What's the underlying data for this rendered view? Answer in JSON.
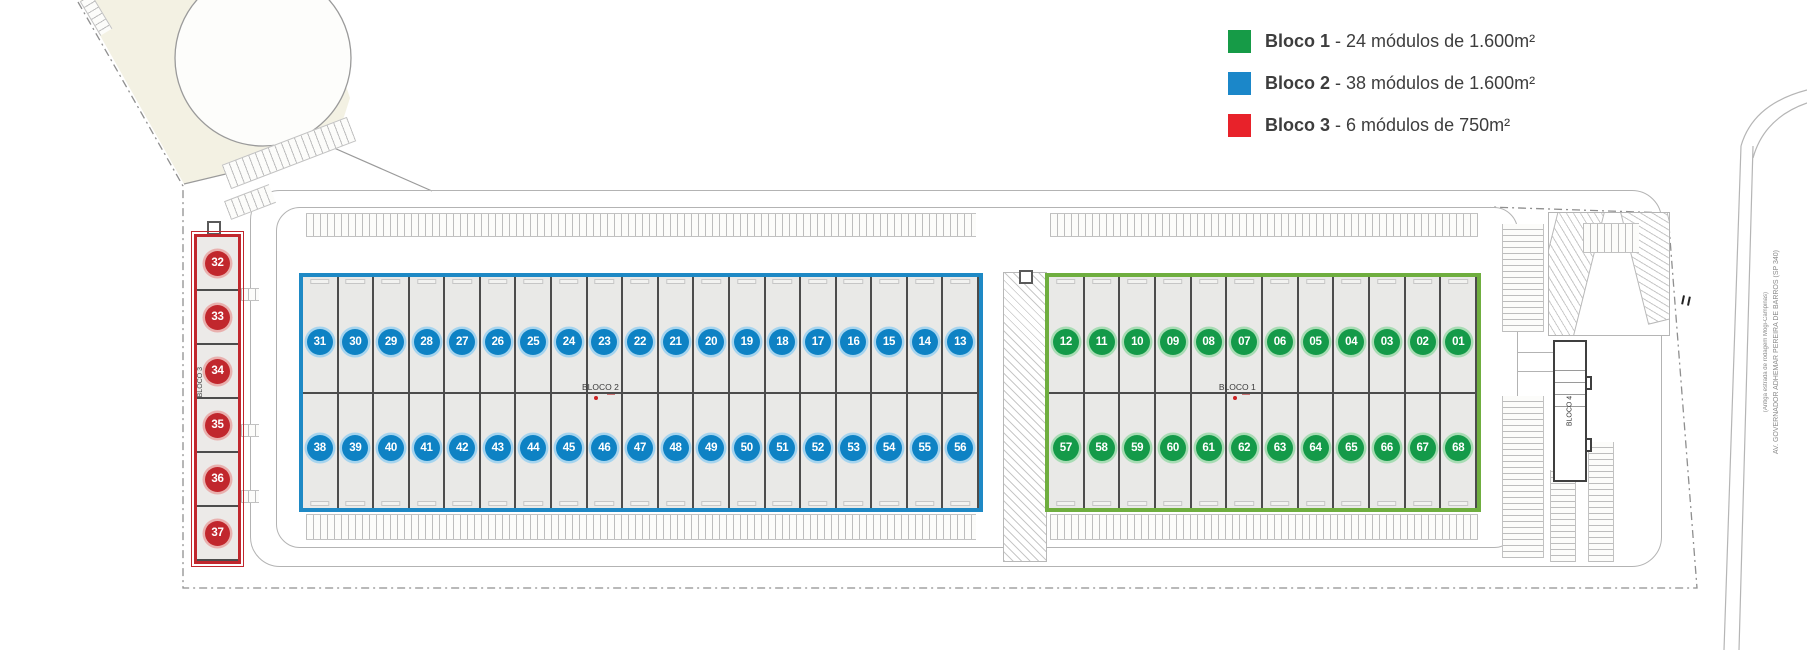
{
  "legend": {
    "items": [
      {
        "name": "Bloco 1",
        "desc": " - 24 módulos de 1.600m²",
        "color": "#169b47"
      },
      {
        "name": "Bloco 2",
        "desc": " - 38 módulos de 1.600m²",
        "color": "#1b87c9"
      },
      {
        "name": "Bloco 3",
        "desc": " - 6 módulos de 750m²",
        "color": "#e8222a"
      }
    ]
  },
  "blocks": {
    "bloco2": {
      "label": "BLOCO 2",
      "border_color": "#1e89c5",
      "circle_color": "#0e82c4",
      "ring_color": "#a6d4ee",
      "top_row": [
        "31",
        "30",
        "29",
        "28",
        "27",
        "26",
        "25",
        "24",
        "23",
        "22",
        "21",
        "20",
        "19",
        "18",
        "17",
        "16",
        "15",
        "14",
        "13"
      ],
      "bottom_row": [
        "38",
        "39",
        "40",
        "41",
        "42",
        "43",
        "44",
        "45",
        "46",
        "47",
        "48",
        "49",
        "50",
        "51",
        "52",
        "53",
        "54",
        "55",
        "56"
      ]
    },
    "bloco1": {
      "label": "BLOCO 1",
      "border_color": "#6fae3f",
      "circle_color": "#149a49",
      "ring_color": "#a8dcb4",
      "top_row": [
        "12",
        "11",
        "10",
        "09",
        "08",
        "07",
        "06",
        "05",
        "04",
        "03",
        "02",
        "01"
      ],
      "bottom_row": [
        "57",
        "58",
        "59",
        "60",
        "61",
        "62",
        "63",
        "64",
        "65",
        "66",
        "67",
        "68"
      ]
    },
    "bloco3": {
      "label": "BLOCO 3",
      "border_color": "#c1272d",
      "circle_color": "#c1272d",
      "ring_color": "#e9b0ae",
      "modules": [
        "32",
        "33",
        "34",
        "35",
        "36",
        "37"
      ]
    },
    "bloco4": {
      "label": "BLOCO 4"
    }
  },
  "road": {
    "line1": "AV. GOVERNADOR ADHEMAR PEREIRA DE BARROS (SP 340)",
    "line2": "(Antiga estrada de rodagem Mogi-Campinas)"
  }
}
